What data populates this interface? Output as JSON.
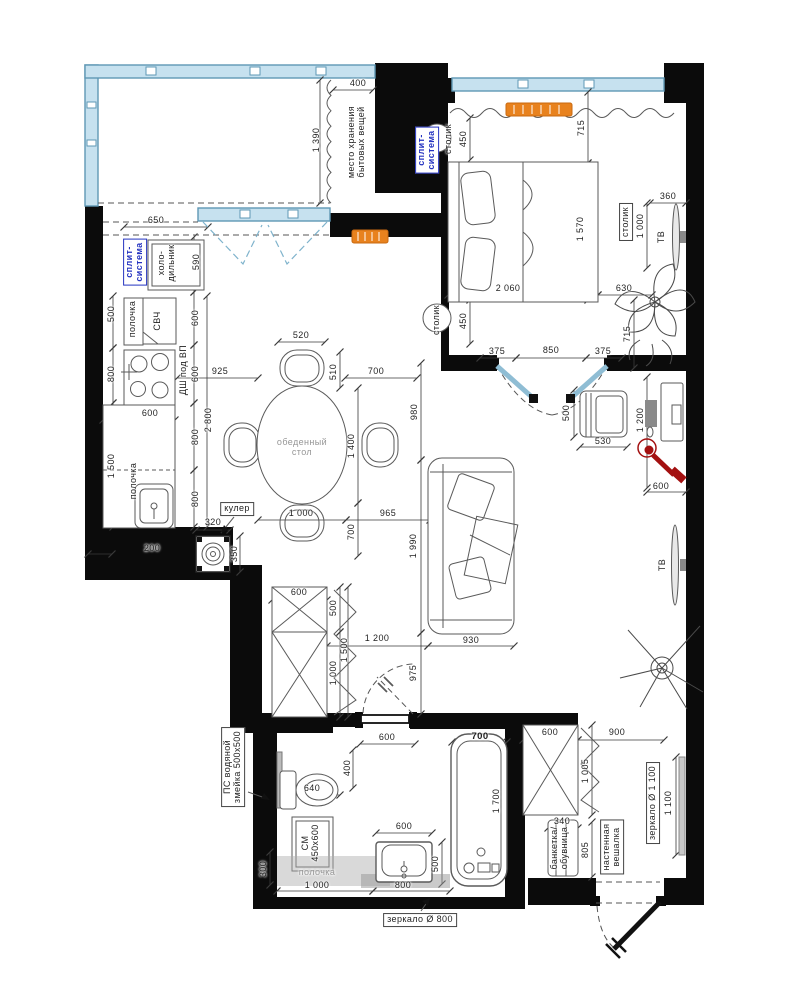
{
  "title": "apartment-floor-plan",
  "colors": {
    "wall": "#0b0b0b",
    "window_fill": "#c6e1ef",
    "window_stroke": "#5f98b5",
    "door_blue": "#8fbdd4",
    "radiator": "#e8821e",
    "radiator_stroke": "#c96a10",
    "blue_label": "#2433c0",
    "lamp_red": "#a31010",
    "furniture_line": "#5a5a5a",
    "dim_line": "#3a3a3a",
    "gray_fill": "#c9c9c9"
  },
  "labels": [
    {
      "t": "400",
      "x": 358,
      "y": 84,
      "r": 0
    },
    {
      "t": "1 390",
      "x": 317,
      "y": 140,
      "r": 1
    },
    {
      "t": "место хранения",
      "t2": "бытовых вещей",
      "x": 357,
      "y": 142,
      "r": 1,
      "n": "storage-label"
    },
    {
      "t": "650",
      "x": 156,
      "y": 221,
      "r": 0
    },
    {
      "t": "сплит-",
      "t2": "система",
      "x": 135,
      "y": 262,
      "r": 1,
      "blue": true,
      "box": true,
      "n": "split-system-kitchen-label"
    },
    {
      "t": "холо-",
      "t2": "дильник",
      "x": 167,
      "y": 263,
      "r": 1,
      "n": "fridge-label"
    },
    {
      "t": "590",
      "x": 197,
      "y": 262,
      "r": 1
    },
    {
      "t": "500",
      "x": 112,
      "y": 314,
      "r": 1
    },
    {
      "t": "полочка",
      "x": 133,
      "y": 319,
      "r": 1,
      "n": "kitchen-shelf-label"
    },
    {
      "t": "СВЧ",
      "x": 158,
      "y": 321,
      "r": 1,
      "n": "microwave-label"
    },
    {
      "t": "600",
      "x": 196,
      "y": 318,
      "r": 1
    },
    {
      "t": "800",
      "x": 112,
      "y": 374,
      "r": 1
    },
    {
      "t": "ДШ под ВП",
      "x": 184,
      "y": 370,
      "r": 1,
      "n": "oven-label"
    },
    {
      "t": "600",
      "x": 196,
      "y": 374,
      "r": 1
    },
    {
      "t": "925",
      "x": 220,
      "y": 372,
      "r": 0
    },
    {
      "t": "600",
      "x": 150,
      "y": 414,
      "r": 0
    },
    {
      "t": "2 800",
      "x": 209,
      "y": 420,
      "r": 1
    },
    {
      "t": "800",
      "x": 196,
      "y": 437,
      "r": 1
    },
    {
      "t": "1 500",
      "x": 112,
      "y": 466,
      "r": 1
    },
    {
      "t": "полочка",
      "x": 134,
      "y": 481,
      "r": 1,
      "n": "kitchen-shelf2-label"
    },
    {
      "t": "800",
      "x": 196,
      "y": 499,
      "r": 1
    },
    {
      "t": "кулер",
      "x": 237,
      "y": 509,
      "r": 0,
      "box": true,
      "n": "cooler-label"
    },
    {
      "t": "320",
      "x": 213,
      "y": 523,
      "r": 0
    },
    {
      "t": "350",
      "x": 235,
      "y": 554,
      "r": 1
    },
    {
      "t": "200",
      "x": 152,
      "y": 549,
      "r": 0
    },
    {
      "t": "520",
      "x": 301,
      "y": 336,
      "r": 0
    },
    {
      "t": "510",
      "x": 334,
      "y": 372,
      "r": 1
    },
    {
      "t": "700",
      "x": 376,
      "y": 372,
      "r": 0
    },
    {
      "t": "980",
      "x": 415,
      "y": 412,
      "r": 1
    },
    {
      "t": "1 400",
      "x": 352,
      "y": 446,
      "r": 1
    },
    {
      "t": "обеденный",
      "t2": "стол",
      "x": 302,
      "y": 448,
      "r": 0,
      "gray": true,
      "n": "dining-table-label"
    },
    {
      "t": "1 000",
      "x": 301,
      "y": 514,
      "r": 0
    },
    {
      "t": "965",
      "x": 388,
      "y": 514,
      "r": 0
    },
    {
      "t": "700",
      "x": 352,
      "y": 532,
      "r": 1
    },
    {
      "t": "1 990",
      "x": 414,
      "y": 546,
      "r": 1
    },
    {
      "t": "930",
      "x": 471,
      "y": 641,
      "r": 0
    },
    {
      "t": "975",
      "x": 414,
      "y": 673,
      "r": 1
    },
    {
      "t": "450",
      "x": 464,
      "y": 139,
      "r": 1
    },
    {
      "t": "715",
      "x": 582,
      "y": 128,
      "r": 1
    },
    {
      "t": "сплит-",
      "t2": "система",
      "x": 427,
      "y": 150,
      "r": 1,
      "blue": true,
      "box": true,
      "n": "split-system-bedroom-label"
    },
    {
      "t": "столик",
      "x": 449,
      "y": 139,
      "r": 1,
      "n": "bedside-table-top-label"
    },
    {
      "t": "1 570",
      "x": 581,
      "y": 229,
      "r": 1
    },
    {
      "t": "2 060",
      "x": 508,
      "y": 289,
      "r": 0
    },
    {
      "t": "630",
      "x": 624,
      "y": 289,
      "r": 0
    },
    {
      "t": "360",
      "x": 668,
      "y": 197,
      "r": 0
    },
    {
      "t": "столик",
      "x": 626,
      "y": 222,
      "r": 1,
      "box": true,
      "n": "tv-table-label"
    },
    {
      "t": "1 000",
      "x": 641,
      "y": 226,
      "r": 1
    },
    {
      "t": "ТВ",
      "x": 662,
      "y": 237,
      "r": 1,
      "n": "tv-bedroom-label"
    },
    {
      "t": "столик",
      "x": 437,
      "y": 320,
      "r": 1,
      "n": "bedside-table-bottom-label"
    },
    {
      "t": "450",
      "x": 464,
      "y": 321,
      "r": 1
    },
    {
      "t": "375",
      "x": 497,
      "y": 352,
      "r": 0
    },
    {
      "t": "850",
      "x": 551,
      "y": 351,
      "r": 0
    },
    {
      "t": "375",
      "x": 603,
      "y": 352,
      "r": 0
    },
    {
      "t": "715",
      "x": 628,
      "y": 334,
      "r": 1
    },
    {
      "t": "500",
      "x": 567,
      "y": 413,
      "r": 1
    },
    {
      "t": "530",
      "x": 603,
      "y": 442,
      "r": 0
    },
    {
      "t": "1 200",
      "x": 641,
      "y": 420,
      "r": 1
    },
    {
      "t": "600",
      "x": 661,
      "y": 487,
      "r": 0
    },
    {
      "t": "600",
      "x": 299,
      "y": 593,
      "r": 0
    },
    {
      "t": "500",
      "x": 334,
      "y": 608,
      "r": 1
    },
    {
      "t": "1 500",
      "x": 345,
      "y": 650,
      "r": 1
    },
    {
      "t": "1 000",
      "x": 334,
      "y": 673,
      "r": 1
    },
    {
      "t": "1 200",
      "x": 377,
      "y": 639,
      "r": 0
    },
    {
      "t": "600",
      "x": 387,
      "y": 738,
      "r": 0
    },
    {
      "t": "ТВ",
      "x": 663,
      "y": 565,
      "r": 1,
      "n": "tv-living-label"
    },
    {
      "t": "600",
      "x": 550,
      "y": 733,
      "r": 0
    },
    {
      "t": "900",
      "x": 617,
      "y": 733,
      "r": 0
    },
    {
      "t": "1 005",
      "x": 586,
      "y": 771,
      "r": 1
    },
    {
      "t": "340",
      "x": 562,
      "y": 822,
      "r": 0
    },
    {
      "t": "805",
      "x": 586,
      "y": 850,
      "r": 1
    },
    {
      "t": "банкетка/",
      "t2": "обувница",
      "x": 560,
      "y": 848,
      "r": 1,
      "n": "bench-label"
    },
    {
      "t": "настенная",
      "t2": "вешалка",
      "x": 612,
      "y": 847,
      "r": 1,
      "box": true,
      "n": "wall-hanger-label"
    },
    {
      "t": "зеркало Ø 1 100",
      "x": 653,
      "y": 803,
      "r": 1,
      "box": true,
      "n": "mirror-hall-label"
    },
    {
      "t": "1 100",
      "x": 669,
      "y": 803,
      "r": 1
    },
    {
      "t": "ПС водяной",
      "t2": "змейка 500х500",
      "x": 233,
      "y": 767,
      "r": 1,
      "box": true,
      "n": "towel-rail-label"
    },
    {
      "t": "400",
      "x": 348,
      "y": 768,
      "r": 1
    },
    {
      "t": "640",
      "x": 312,
      "y": 789,
      "r": 0
    },
    {
      "t": "700",
      "x": 480,
      "y": 737,
      "r": 0,
      "bold": true
    },
    {
      "t": "1 700",
      "x": 497,
      "y": 801,
      "r": 1
    },
    {
      "t": "600",
      "x": 404,
      "y": 827,
      "r": 0
    },
    {
      "t": "500",
      "x": 436,
      "y": 864,
      "r": 1
    },
    {
      "t": "СМ",
      "t2": "450х600",
      "x": 311,
      "y": 843,
      "r": 1,
      "n": "washer-label"
    },
    {
      "t": "полочка",
      "x": 317,
      "y": 873,
      "r": 0,
      "gray": true,
      "n": "bath-shelf-label"
    },
    {
      "t": "300",
      "x": 264,
      "y": 869,
      "r": 1
    },
    {
      "t": "1 000",
      "x": 317,
      "y": 886,
      "r": 0
    },
    {
      "t": "800",
      "x": 403,
      "y": 886,
      "r": 0
    },
    {
      "t": "зеркало Ø 800",
      "x": 420,
      "y": 920,
      "r": 0,
      "box": true,
      "n": "mirror-bath-label"
    }
  ]
}
